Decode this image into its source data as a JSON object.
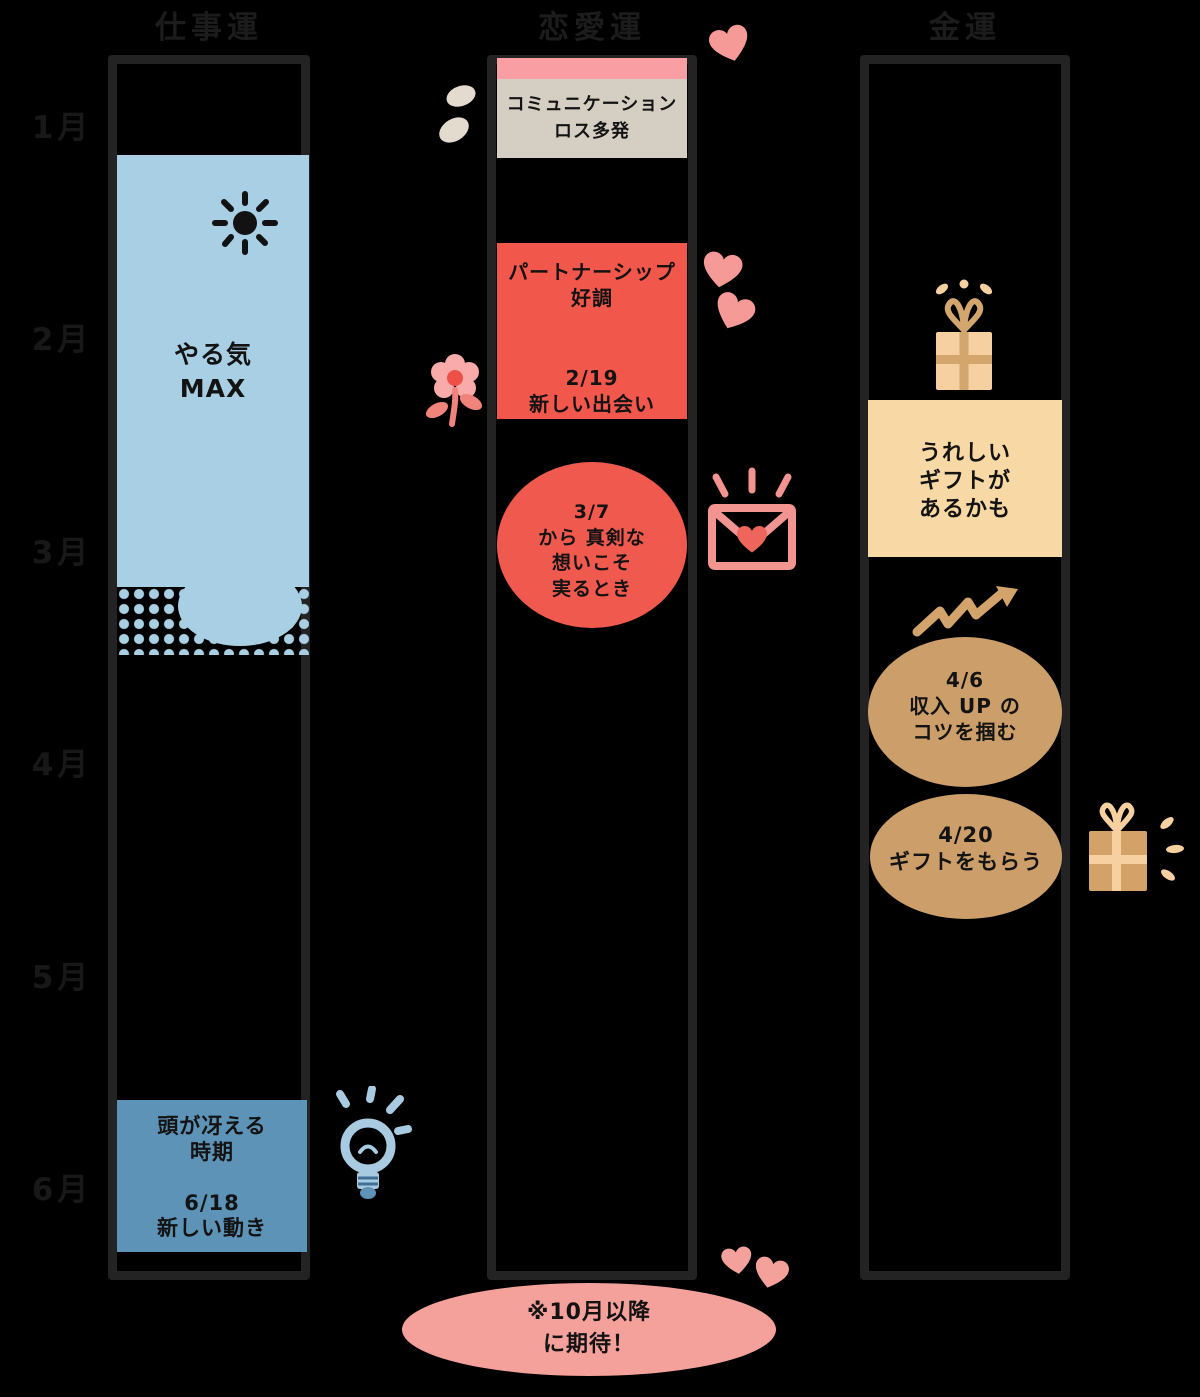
{
  "months": [
    "1月",
    "2月",
    "3月",
    "4月",
    "5月",
    "6月"
  ],
  "columns": {
    "work": {
      "title": "仕事運",
      "motivation_block": "やる気\nMAX",
      "june_block": "頭が冴える\n時期\n\n6/18\n新しい動き"
    },
    "love": {
      "title": "恋愛運",
      "january_block": "コミュニケーション\nロス多発",
      "february_block": "パートナーシップ\n好調\n\n\n2/19\n新しい出会い",
      "march_oval": "3/7\nから 真剣な\n想いこそ\n実るとき"
    },
    "money": {
      "title": "金運",
      "gift_block": "うれしい\nギフトが\nあるかも",
      "april_oval_1": "4/6\n収入 UP の\nコツを掴む",
      "april_oval_2": "4/20\nギフトをもらう"
    }
  },
  "footer": {
    "note": "※10月以降\nに期待！"
  },
  "icons": {
    "sun": "sun-icon",
    "sparkle_drops": "sparkle-drops-icon",
    "flower": "flower-icon",
    "heart": "heart-icon",
    "envelope": "love-letter-icon",
    "gift": "gift-icon",
    "trend_up": "trend-up-arrow-icon",
    "lightbulb": "lightbulb-icon"
  },
  "palette": {
    "background": "#000000",
    "outline": "#232323",
    "label_text": "#1c1c1c",
    "block_text": "#131313",
    "light_blue": "#a9cfe4",
    "steel_blue": "#5d93b6",
    "pink_strip": "#f99fa4",
    "gray_block": "#d4cfc2",
    "red_block": "#f2574c",
    "red_oval": "#f0594e",
    "peach_block": "#f8d8a4",
    "tan_oval": "#cb9e6a",
    "gift_tan": "#d2a269",
    "gift_light": "#f6d0a0",
    "footer_pink": "#f4a19b",
    "heart_pink": "#f59a96",
    "beige_drop": "#e3dcce",
    "bulb_blue": "#a9cbe2"
  }
}
